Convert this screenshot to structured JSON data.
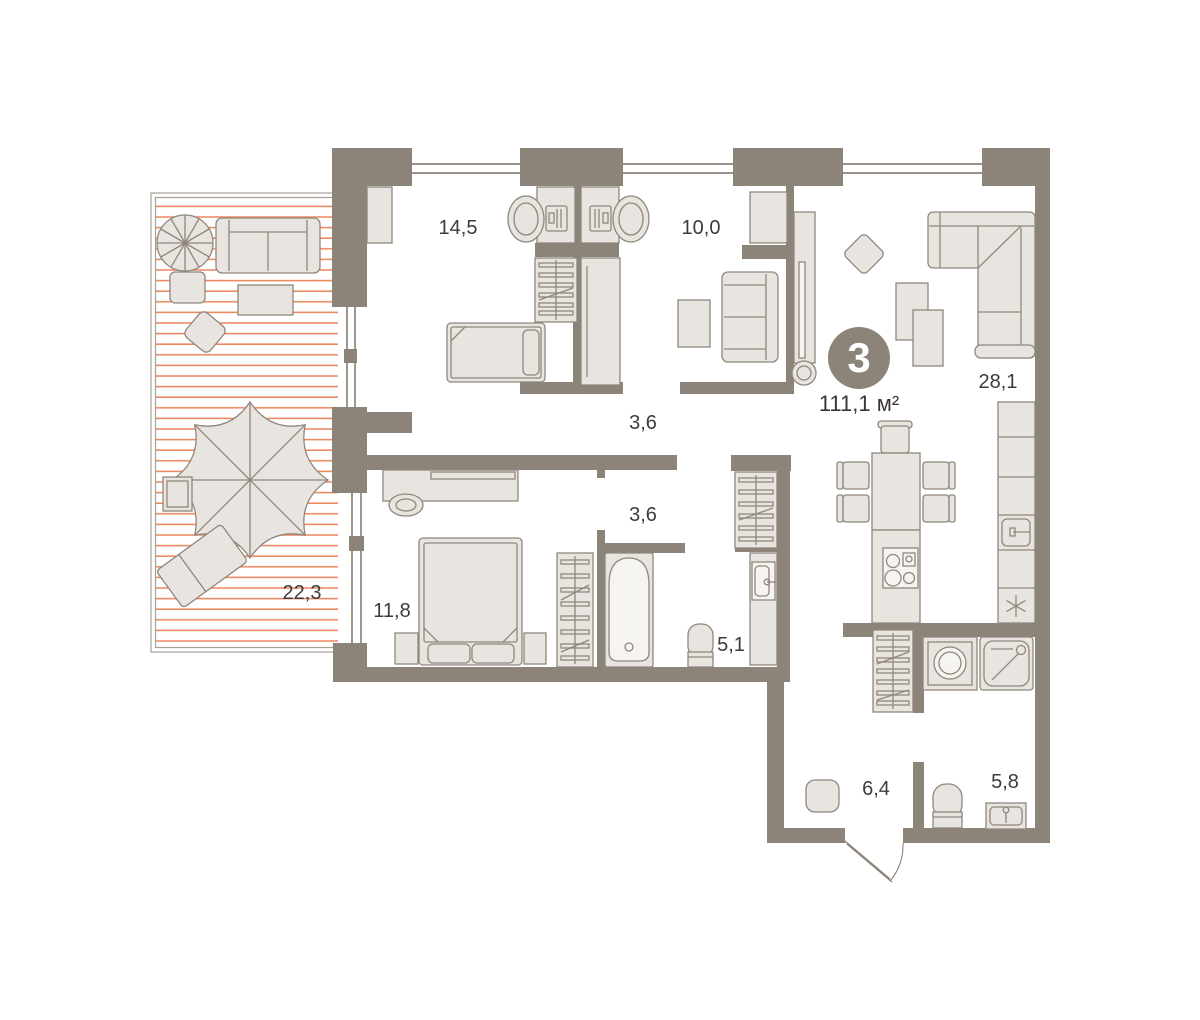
{
  "plan": {
    "badge_rooms_count": "3",
    "total_area": "111,1 м²",
    "rooms": {
      "bedroom_main": {
        "area": "14,5"
      },
      "bedroom_second": {
        "area": "10,0"
      },
      "living_kitchen": {
        "area": "28,1"
      },
      "corridor": {
        "area": "3,6"
      },
      "inner_hall": {
        "area": "3,6"
      },
      "bedroom_third": {
        "area": "11,8"
      },
      "terrace": {
        "area": "22,3"
      },
      "bathroom": {
        "area": "5,1"
      },
      "hallway": {
        "area": "6,4"
      },
      "wc": {
        "area": "5,8"
      }
    },
    "colors": {
      "wall": "#8c8379",
      "furniture_fill": "#e8e4df",
      "furniture_stroke": "#90877d",
      "terrace_hatch": "#ec8a63",
      "terrace_border": "#a8a096",
      "label_text": "#3c3c3c",
      "badge_fill": "#8c8379",
      "badge_text": "#ffffff",
      "background": "#ffffff"
    }
  }
}
